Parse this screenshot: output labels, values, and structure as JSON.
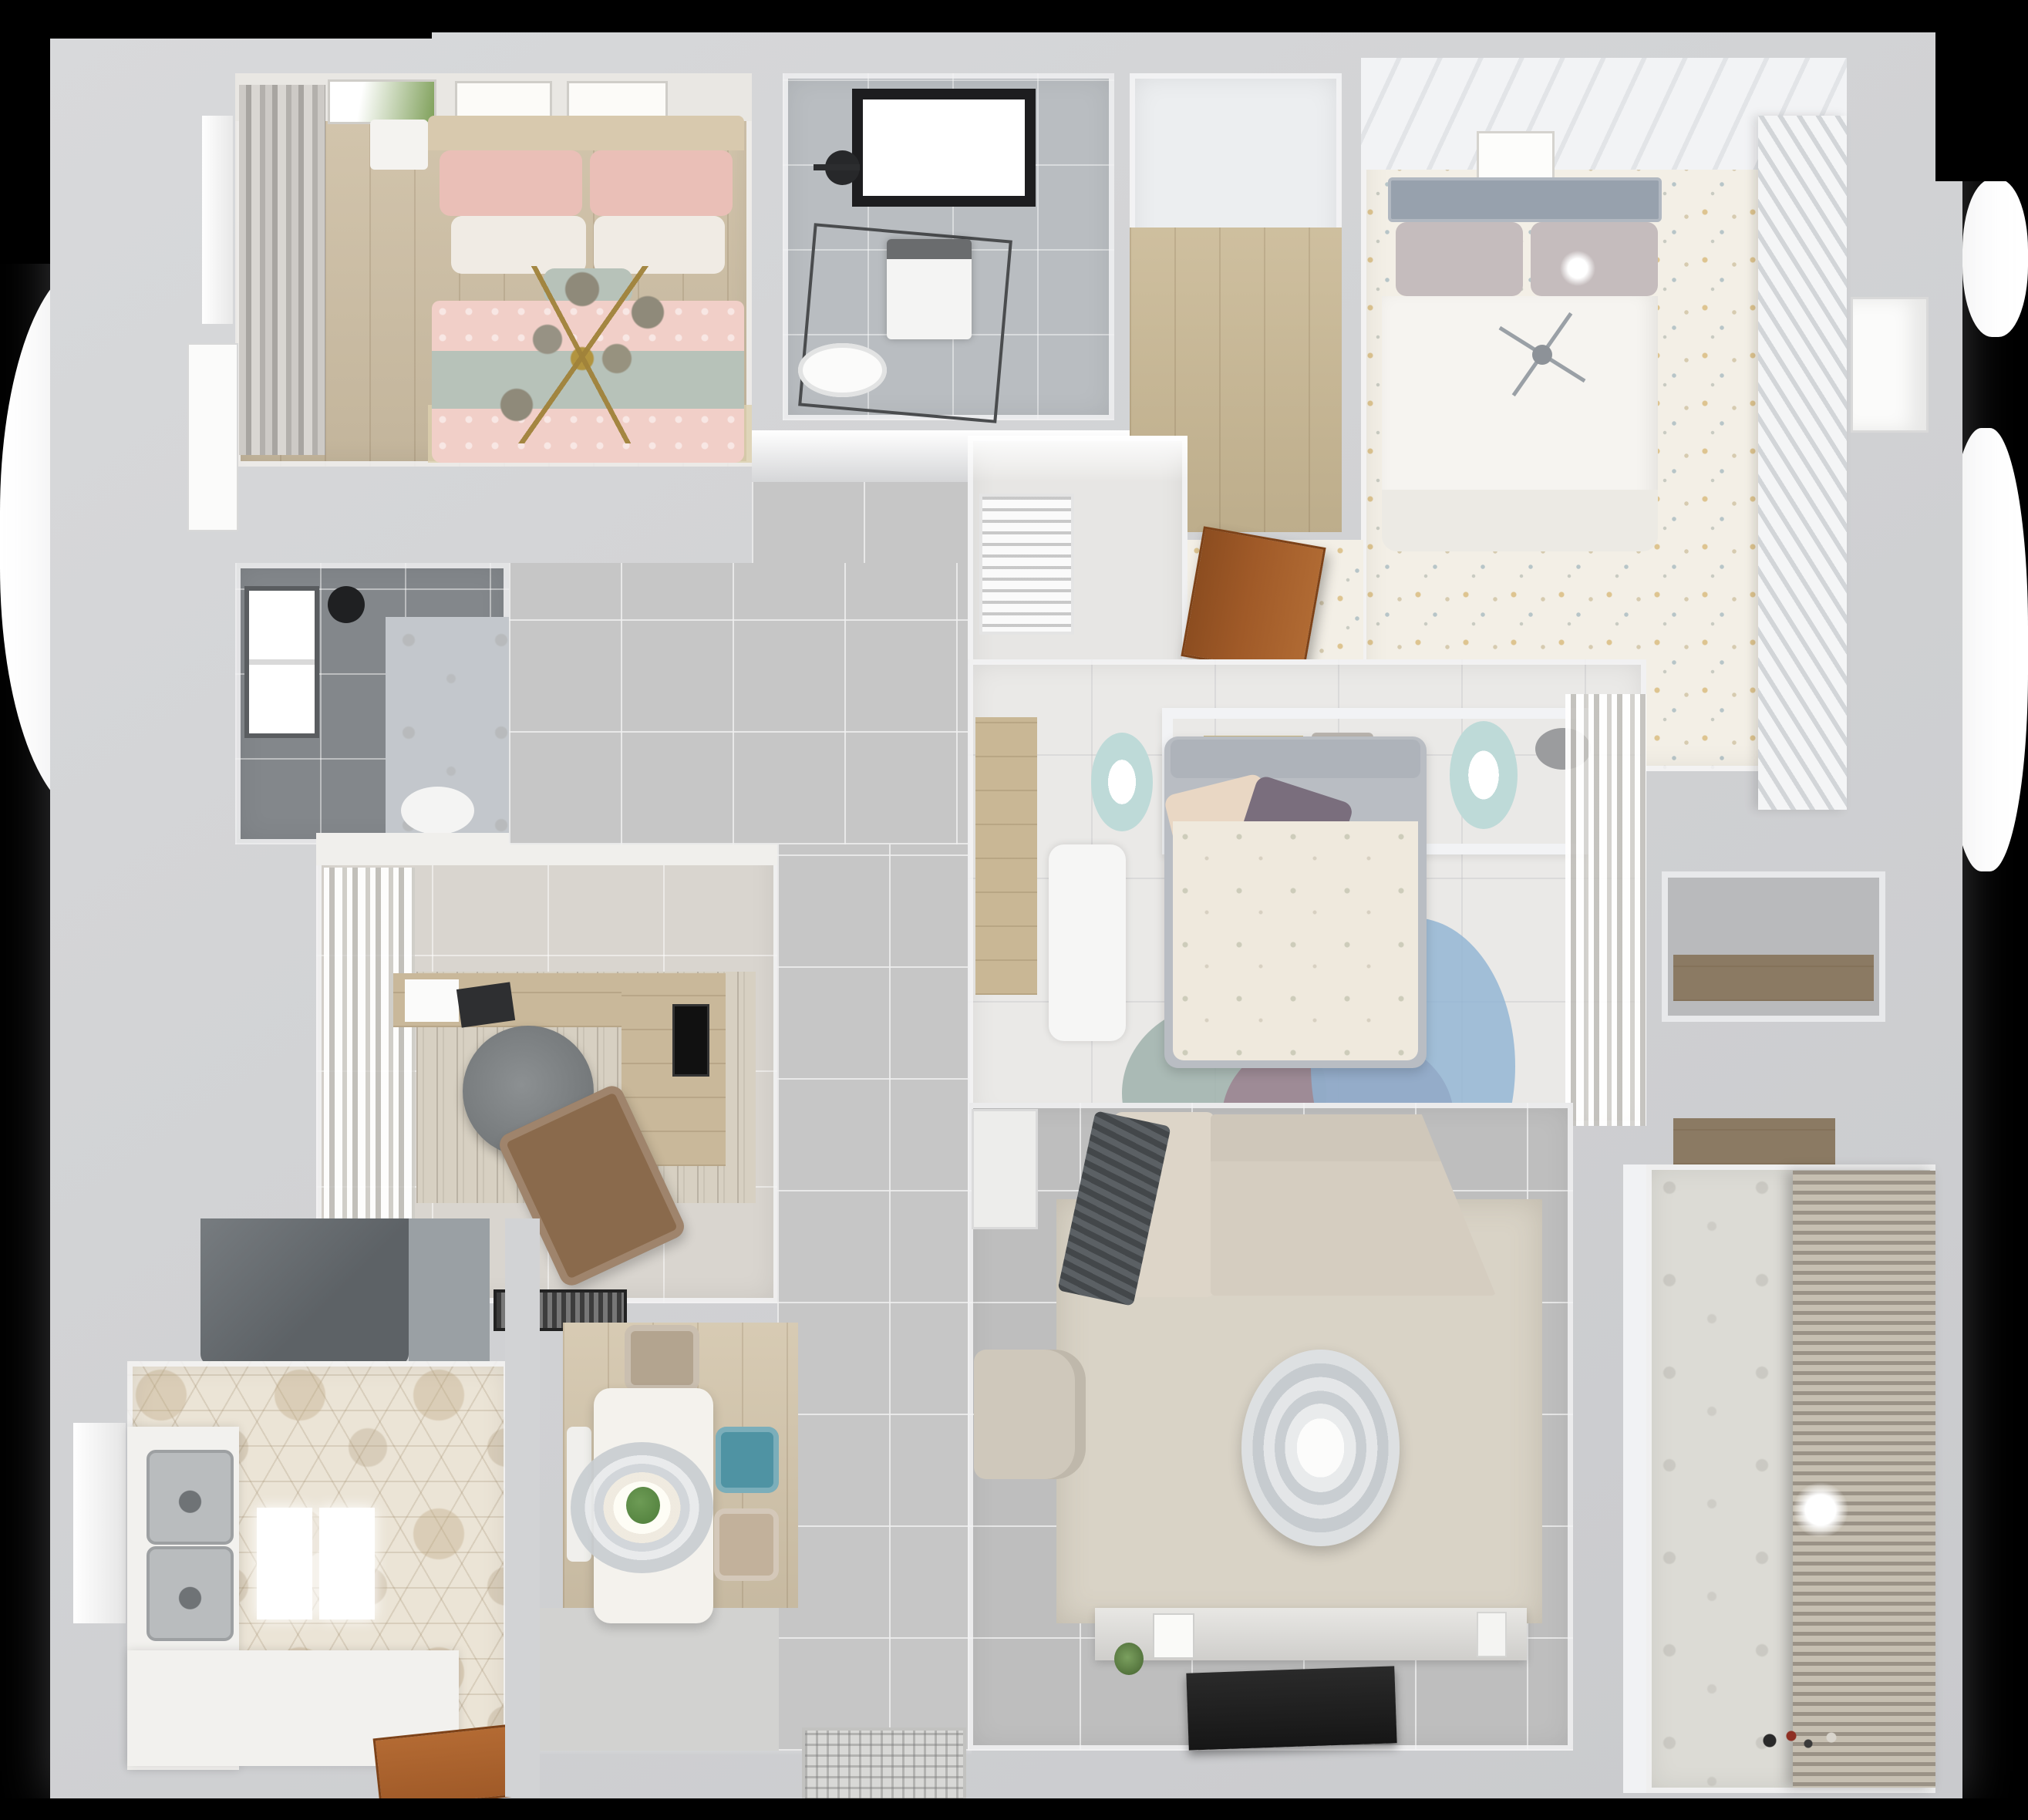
{
  "scene": {
    "title": "Apartment 3D floor plan — top-down render",
    "style": "photoreal top view, no visible text"
  },
  "palette": {
    "bg": "#000000",
    "glow": "#ffffff",
    "wall_outer": "#d2d3d5",
    "wall_inner": "#f1f2f4",
    "floor_wood": "#cfc0a5",
    "floor_wood_light": "#dccfae",
    "floor_closet": "#c9b894",
    "floor_hall": "#c6c6c6",
    "floor_living": "#bebebe",
    "floor_marble": "#eae9e7",
    "floor_confetti": "#f3efe6",
    "floor_hex": "#ebe4d6",
    "floor_bath1": "#b9bdc1",
    "floor_bath2": "#83878b",
    "floor_vestibule": "#e7e6e4",
    "floor_balcony": "#dcdbd5",
    "floor_dining_wood": "#d3c5ab",
    "curtain_grey": "#b3b0ac",
    "curtain_white": "#f0efec",
    "bed1_pink": "#f1cfc8",
    "bed1_pink_deep": "#eabfb7",
    "bed1_sage": "#b7c2b9",
    "bed1_headboard": "#d8c9ae",
    "pillow_white": "#f0ebe4",
    "gold": "#b2943f",
    "bed2_white": "#f6f4f0",
    "bed2_headboard": "#97a1ad",
    "bed2_pillow": "#c5bcbd",
    "wardrobe": "#eef0f1",
    "bed3_duvet": "#efe9dd",
    "bed3_pillow_purple": "#7a6e7d",
    "bed3_pillow_cream": "#e9d7c4",
    "bed3_frame": "#b9bdc3",
    "rug_blue": "#8fb3d3",
    "rug_mauve": "#9c8290",
    "rug_sage": "#9fb1ac",
    "stool_teal": "#bedad8",
    "desk_white": "#f6f6f5",
    "sofa": "#d5cdc0",
    "sofa_light": "#ddd5c8",
    "throw_dark": "#4e5255",
    "rug_living": "#d9d3c6",
    "rug_study": "#d7d0c2",
    "chair_office": "#75797b",
    "chair_lounge": "#8a6a4c",
    "wood_door": "#a05a28",
    "hood": "#5d6266",
    "steel": "#b9bcbe",
    "tv": "#161616",
    "counter": "#f2f1ee",
    "table_white": "#f4f2ed",
    "chair_taupe": "#b3a48f",
    "chair_teal": "#4f93a3",
    "chair_beige": "#c2b19b",
    "blinds_dark": "#9a9286",
    "blinds_light": "#c6bfb1",
    "plant": "#4e7d3a",
    "art_green": "#7fa05a",
    "skylight_frame": "#1d1d1f"
  },
  "rooms": [
    {
      "id": "bedroom-1",
      "name": "Bedroom 1 — pink bed",
      "furniture": [
        "headboard",
        "pink-pillows",
        "white-pillows",
        "sage-throw",
        "pink-duvet",
        "gold-branch-chandelier",
        "grey-curtains",
        "art-frames",
        "nightstand",
        "window",
        "white-door"
      ]
    },
    {
      "id": "bathroom-1",
      "name": "Bathroom 1 — shower room",
      "furniture": [
        "black-framed-skylight",
        "shower-fixture",
        "glass-shower-enclosure",
        "washing-machine",
        "toilet"
      ]
    },
    {
      "id": "closet-corridor",
      "name": "Closet corridor — wood floor",
      "furniture": [
        "plank-floor"
      ]
    },
    {
      "id": "bedroom-2",
      "name": "Bedroom 2 — white bed, confetti floor",
      "furniture": [
        "grey-headboard",
        "white-duvet",
        "ball-lamp",
        "stick-chandelier",
        "slatted-wardrobe",
        "art-frame",
        "console",
        "plant"
      ]
    },
    {
      "id": "vestibule",
      "name": "Vestibule by bathroom",
      "furniture": [
        "air-vent-louver",
        "open-wood-door"
      ]
    },
    {
      "id": "bedroom-3",
      "name": "Master bedroom",
      "furniture": [
        "grey-framed-bed",
        "floral-duvet",
        "purple-pillow",
        "cream-pillow",
        "headboard-shelf",
        "books",
        "hat",
        "teal-stool-left",
        "teal-stool-right",
        "white-desk",
        "wood-wall-panel",
        "round-rugs-blue-mauve-sage",
        "sheer-curtains"
      ]
    },
    {
      "id": "bathroom-2",
      "name": "Bathroom 2 — dark tiles",
      "furniture": [
        "window",
        "shower-head",
        "marble-wall",
        "toilet"
      ]
    },
    {
      "id": "study",
      "name": "Study",
      "furniture": [
        "l-shaped-desk",
        "monitor",
        "office-chair",
        "brown-lounge-chair",
        "rug",
        "curtains",
        "pelmet",
        "doormat"
      ]
    },
    {
      "id": "hallway",
      "name": "Hallway — grey tiles",
      "furniture": []
    },
    {
      "id": "kitchen",
      "name": "Kitchen — hex tile floor",
      "furniture": [
        "range-hood",
        "double-stainless-sink",
        "l-shaped-counter",
        "window",
        "bright-panels",
        "wood-door"
      ]
    },
    {
      "id": "dining",
      "name": "Dining area",
      "furniture": [
        "white-table",
        "ring-pendant-lamp",
        "plant-centerpiece",
        "taupe-chair",
        "teal-chair",
        "beige-chair",
        "bench"
      ]
    },
    {
      "id": "living",
      "name": "Living room",
      "furniture": [
        "corner-sofa",
        "dark-throw",
        "side-table",
        "beige-rug",
        "round-coffee-table",
        "armchair",
        "tv-console",
        "flat-tv",
        "decor"
      ]
    },
    {
      "id": "balcony",
      "name": "Balcony / laundry",
      "furniture": [
        "wood-shelf",
        "roller-blinds",
        "ceiling-lamp",
        "toys"
      ]
    },
    {
      "id": "right-corridor",
      "name": "Right corridor with niche",
      "furniture": [
        "wood-shelf-niche",
        "white-door"
      ]
    },
    {
      "id": "entry",
      "name": "Entry",
      "furniture": [
        "ornate-doormat"
      ]
    }
  ]
}
